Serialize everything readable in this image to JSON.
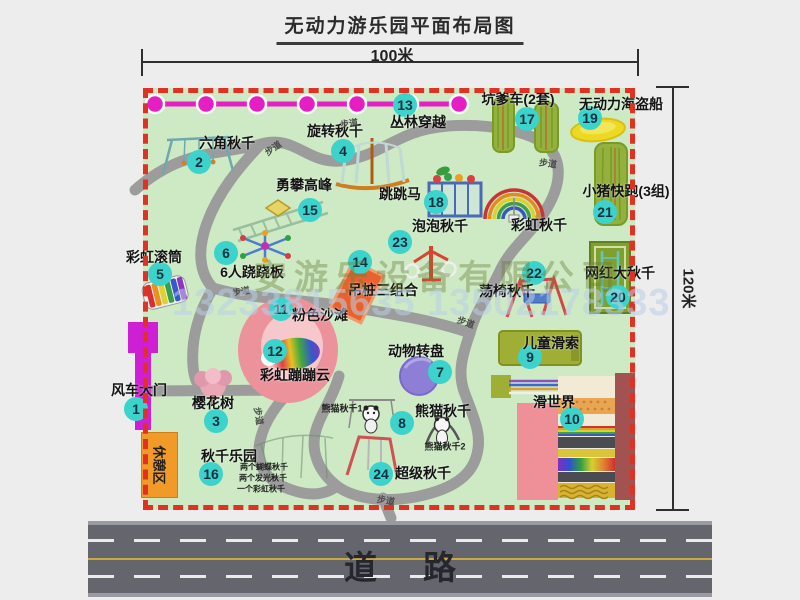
{
  "title": "无动力游乐园平面布局图",
  "dimensions": {
    "width_label": "100米",
    "height_label": "120米"
  },
  "road": {
    "label": "道路"
  },
  "rest_area": {
    "label": "休憩区"
  },
  "watermark": {
    "company": "安游乐设备有限公司",
    "phone": "13233815635 13502178333"
  },
  "walkway": {
    "text": "步道",
    "positions": [
      {
        "x": 206,
        "y": 35,
        "rot": -8
      },
      {
        "x": 130,
        "y": 60,
        "rot": -35
      },
      {
        "x": 405,
        "y": 75,
        "rot": 8
      },
      {
        "x": 98,
        "y": 203,
        "rot": -10
      },
      {
        "x": 323,
        "y": 234,
        "rot": 20
      },
      {
        "x": 116,
        "y": 328,
        "rot": 80
      },
      {
        "x": 243,
        "y": 412,
        "rot": 10
      }
    ]
  },
  "attractions": [
    {
      "id": "windmill-gate",
      "num": 1,
      "label": "风车大门",
      "bx": -7,
      "by": 321,
      "lx": -4,
      "ly": 302
    },
    {
      "id": "hexagon-swing",
      "num": 2,
      "label": "六角秋千",
      "bx": 56,
      "by": 74,
      "lx": 84,
      "ly": 55
    },
    {
      "id": "cherry-tree",
      "num": 3,
      "label": "樱花树",
      "bx": 73,
      "by": 333,
      "lx": 70,
      "ly": 315
    },
    {
      "id": "rotating-swing",
      "num": 4,
      "label": "旋转秋千",
      "bx": 200,
      "by": 63,
      "lx": 192,
      "ly": 43
    },
    {
      "id": "rainbow-roller",
      "num": 5,
      "label": "彩虹滚筒",
      "bx": 17,
      "by": 186,
      "lx": 11,
      "ly": 169
    },
    {
      "id": "six-person-seesaw",
      "num": 6,
      "label": "6人跷跷板",
      "bx": 83,
      "by": 165,
      "lx": 109,
      "ly": 184
    },
    {
      "id": "animal-turntable",
      "num": 7,
      "label": "动物转盘",
      "bx": 297,
      "by": 284,
      "lx": 273,
      "ly": 263
    },
    {
      "id": "panda-swing",
      "num": 8,
      "label": "熊猫秋千",
      "bx": 259,
      "by": 335,
      "lx": 300,
      "ly": 323
    },
    {
      "id": "kids-zipline",
      "num": 9,
      "label": "儿童滑索",
      "bx": 387,
      "by": 269,
      "lx": 408,
      "ly": 255
    },
    {
      "id": "slide-world",
      "num": 10,
      "label": "滑世界",
      "bx": 429,
      "by": 331,
      "lx": 411,
      "ly": 314
    },
    {
      "id": "pink-beach",
      "num": 11,
      "label": "粉色沙滩",
      "bx": 138,
      "by": 221,
      "lx": 177,
      "ly": 227
    },
    {
      "id": "rainbow-bouncing-cloud",
      "num": 12,
      "label": "彩虹蹦蹦云",
      "bx": 132,
      "by": 263,
      "lx": 152,
      "ly": 287
    },
    {
      "id": "jungle-crossing",
      "num": 13,
      "label": "丛林穿越",
      "bx": 262,
      "by": 17,
      "lx": 275,
      "ly": 34
    },
    {
      "id": "hanging-post-combo",
      "num": 14,
      "label": "吊桩三组合",
      "bx": 217,
      "by": 174,
      "lx": 240,
      "ly": 202
    },
    {
      "id": "peak-climbing",
      "num": 15,
      "label": "勇攀高峰",
      "bx": 167,
      "by": 122,
      "lx": 161,
      "ly": 97
    },
    {
      "id": "swing-park",
      "num": 16,
      "label": "秋千乐园",
      "bx": 68,
      "by": 386,
      "lx": 86,
      "ly": 368
    },
    {
      "id": "kengdie-car",
      "num": 17,
      "label": "坑爹车(2套)",
      "bx": 384,
      "by": 31,
      "lx": 375,
      "ly": 11
    },
    {
      "id": "jumping-horse",
      "num": 18,
      "label": "跳跳马",
      "bx": 293,
      "by": 114,
      "lx": 257,
      "ly": 106
    },
    {
      "id": "pirate-ship",
      "num": 19,
      "label": "无动力海盗船",
      "bx": 447,
      "by": 30,
      "lx": 478,
      "ly": 16
    },
    {
      "id": "big-net-swing",
      "num": 20,
      "label": "网红大秋千",
      "bx": 475,
      "by": 209,
      "lx": 477,
      "ly": 185
    },
    {
      "id": "piggy-run",
      "num": 21,
      "label": "小猪快跑(3组)",
      "bx": 462,
      "by": 124,
      "lx": 483,
      "ly": 103
    },
    {
      "id": "chair-swing",
      "num": 22,
      "label": "荡椅秋千",
      "bx": 391,
      "by": 185,
      "lx": 364,
      "ly": 203
    },
    {
      "id": "bubble-swing",
      "num": 23,
      "label": "泡泡秋千",
      "bx": 257,
      "by": 154,
      "lx": 297,
      "ly": 138
    },
    {
      "id": "super-swing",
      "num": 24,
      "label": "超级秋千",
      "bx": 238,
      "by": 386,
      "lx": 280,
      "ly": 385
    },
    {
      "id": "rainbow-swing",
      "num": null,
      "label": "彩虹秋千",
      "lx": 396,
      "ly": 137
    }
  ],
  "sub_labels": [
    {
      "text": "熊猫秋千1",
      "x": 199,
      "y": 320
    },
    {
      "text": "熊猫秋千2",
      "x": 302,
      "y": 358
    },
    {
      "text": "两个蝴蝶秋千",
      "x": 121,
      "y": 379,
      "small": true
    },
    {
      "text": "两个发光秋千",
      "x": 120,
      "y": 390,
      "small": true
    },
    {
      "text": "一个彩虹秋千",
      "x": 118,
      "y": 401,
      "small": true
    }
  ]
}
